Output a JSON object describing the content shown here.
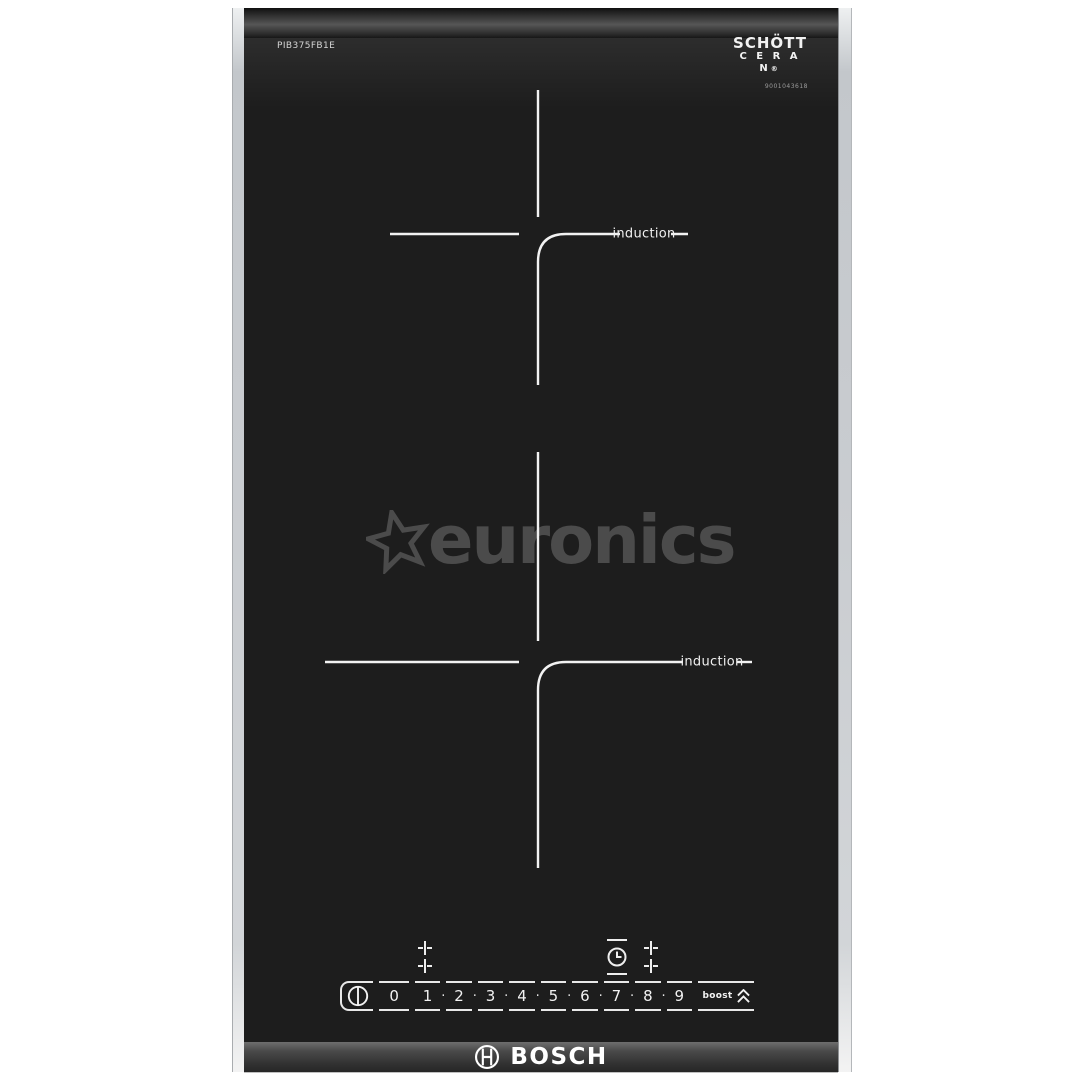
{
  "product": {
    "model": "PIB375FB1E",
    "glass_logo": {
      "line1": "SCHÖTT",
      "line2": "C E R A N",
      "registered": "®",
      "serial": "9001043618"
    },
    "zones": [
      {
        "label": "induction"
      },
      {
        "label": "induction"
      }
    ],
    "brand": "BOSCH"
  },
  "watermark": {
    "text": "euronics"
  },
  "panel": {
    "levels": [
      "0",
      "1",
      "2",
      "3",
      "4",
      "5",
      "6",
      "7",
      "8",
      "9"
    ],
    "separator": "·",
    "boost_label": "boost",
    "icons": [
      "power-icon",
      "zone-select-icon",
      "timer-icon",
      "zone-select-icon",
      "boost-chevrons-icon"
    ]
  },
  "colors": {
    "glass": "#1d1d1d",
    "frame_silver": "#c9ccd0",
    "print_white": "#f0f0f0",
    "watermark_gray": "#4b4b4b",
    "background": "#ffffff"
  }
}
